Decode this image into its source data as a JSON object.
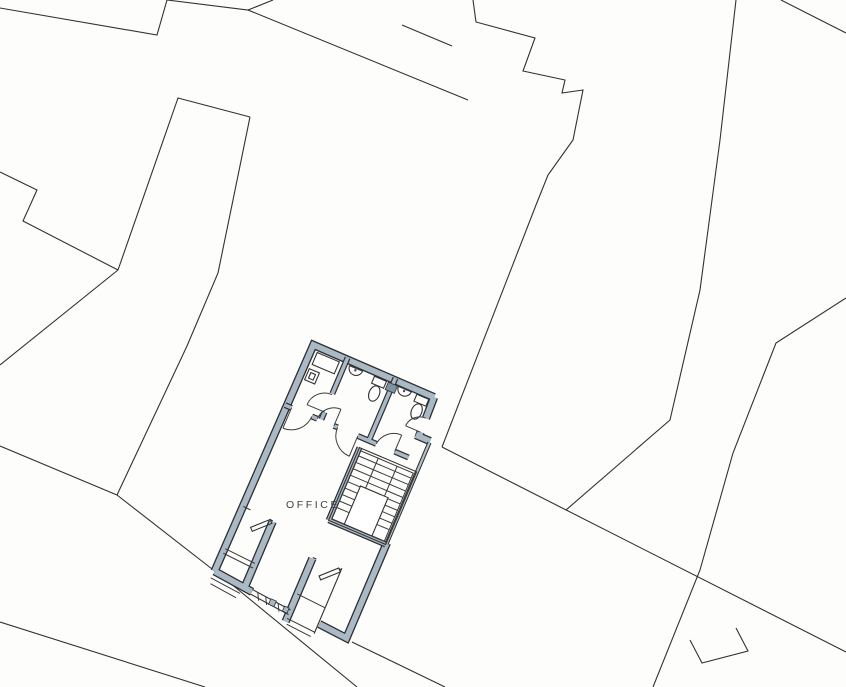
{
  "document": {
    "type": "architectural-site-plan-with-floor-plan",
    "description": "Scanned black-line site plan of surrounding plots with one detailed ground-floor plan highlighted with grey-blue walls"
  },
  "plan": {
    "room_label": "OFFICE",
    "building_rotation_deg": 23,
    "features": [
      "lobby-store-room",
      "wc-cubicle-1",
      "wc-cubicle-2",
      "wash-basin-1",
      "wash-basin-2",
      "toilet-1",
      "toilet-2",
      "dog-leg-staircase",
      "office-room",
      "bay-recess-left",
      "entrance-porch-centre",
      "glazed-shopfront-strip",
      "door-swing-arcs"
    ]
  },
  "site": {
    "parcel_outline_count": 15
  },
  "colors": {
    "background": "#fdfdfc",
    "wall_fill": "#a9b9c6",
    "wall_edge": "#2e2e2e",
    "site_line": "#1f1f1f",
    "label": "#3f3f3f",
    "accent_block": "#7e93a4"
  }
}
